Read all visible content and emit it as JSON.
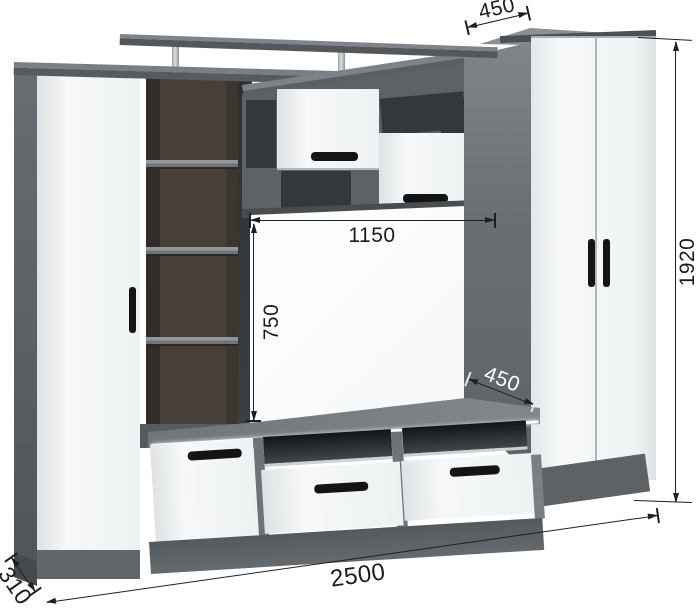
{
  "meta": {
    "title": "Wall unit / TV stand furniture dimension diagram",
    "background": "#ffffff",
    "units_shown": false
  },
  "dims": {
    "top_depth": "450",
    "overall_height": "1920",
    "niche_width": "1150",
    "niche_height": "750",
    "stand_depth": "450",
    "overall_width": "2500",
    "side_depth": "310"
  },
  "colors": {
    "carcass_gray": "#6e7378",
    "plinth_gray": "#5d6266",
    "front_white": "#f5f7f8",
    "interior_wenge": "#463e37",
    "handle_black": "#141414",
    "dimension_ink": "#1f1f1f",
    "led_white": "#ffffff",
    "chrome": "#c6cacd",
    "stand_depth_label": "#ffffff"
  }
}
